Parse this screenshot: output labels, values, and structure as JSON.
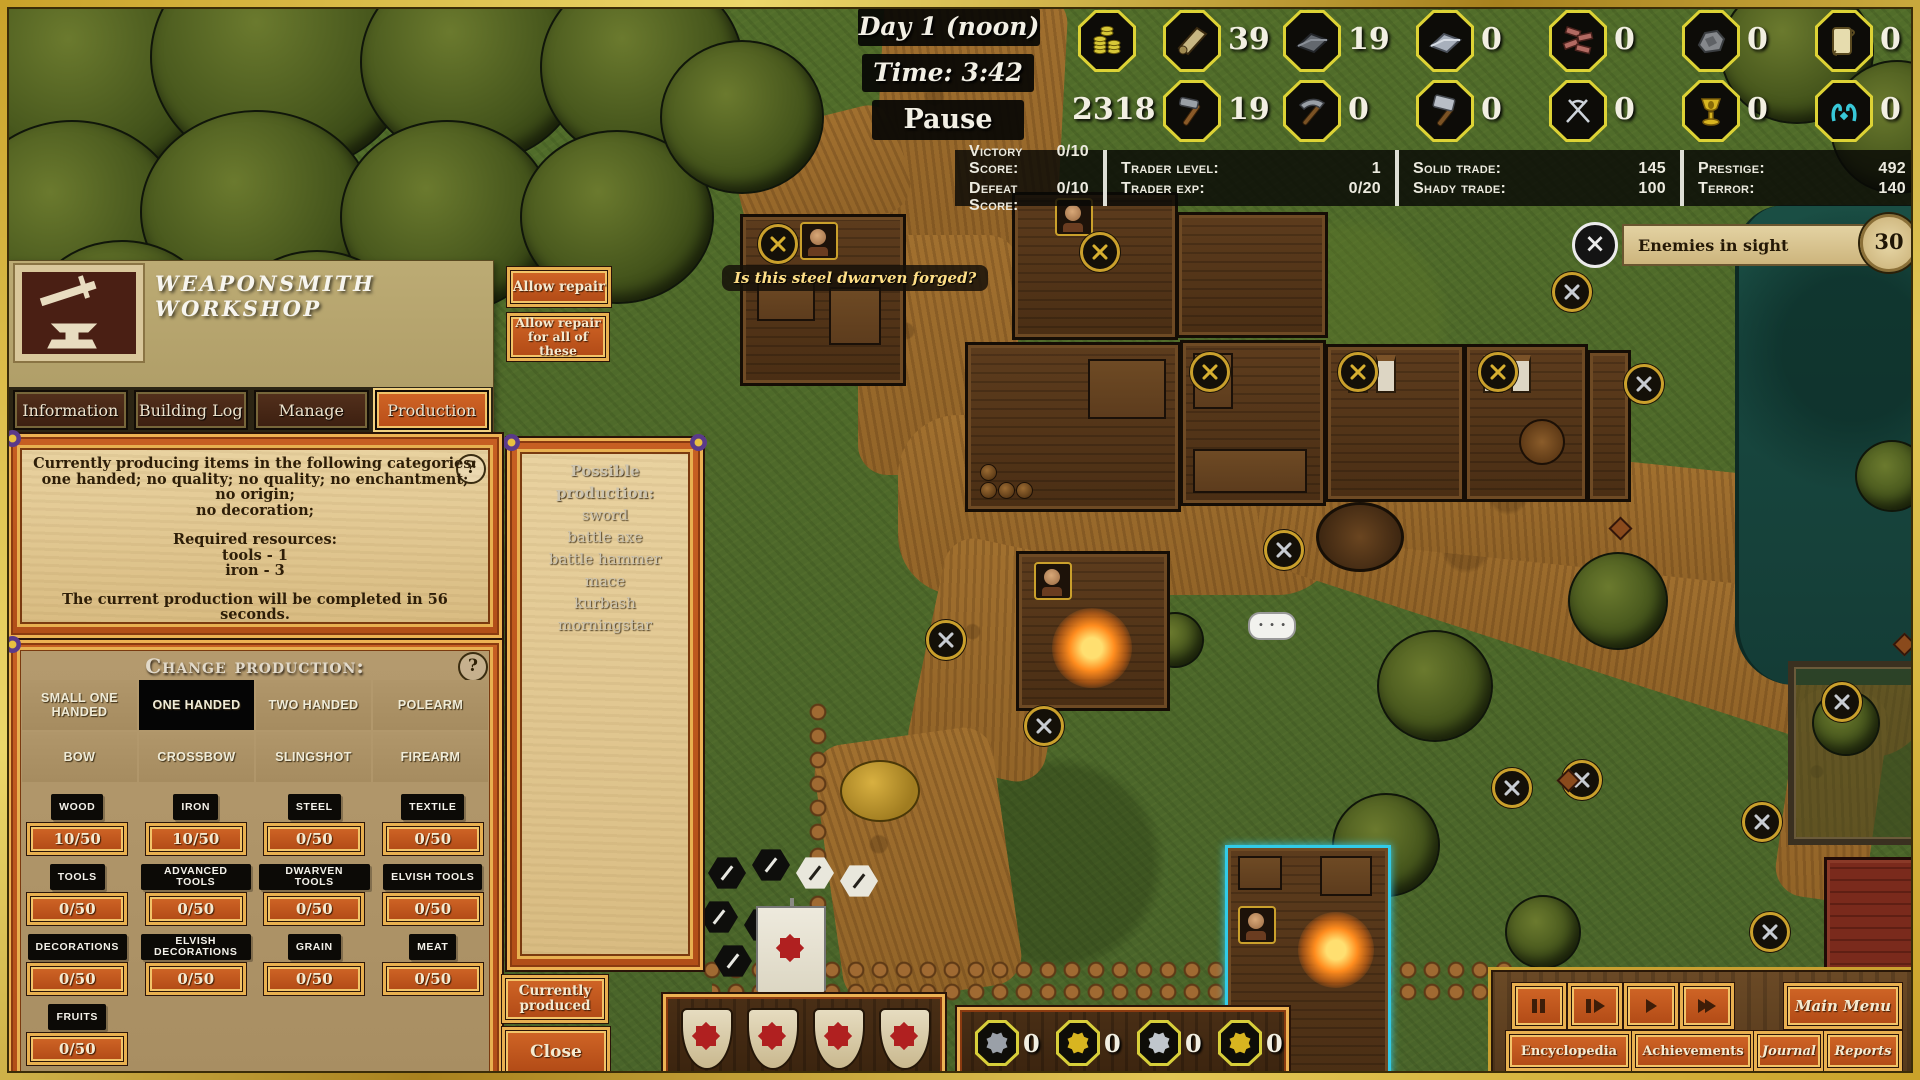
{
  "hud": {
    "day_label": "Day 1 (noon)",
    "time_label": "Time: 3:42",
    "pause_label": "Pause",
    "coins_total": "2318",
    "resources_top": [
      {
        "icon": "coins-icon",
        "count": ""
      },
      {
        "icon": "wood-icon",
        "count": "39"
      },
      {
        "icon": "iron-icon",
        "count": "19"
      },
      {
        "icon": "steel-icon",
        "count": "0"
      },
      {
        "icon": "bricks-icon",
        "count": "0"
      },
      {
        "icon": "stone-icon",
        "count": "0"
      },
      {
        "icon": "scroll-icon",
        "count": "0"
      }
    ],
    "resources_bottom": [
      {
        "icon": "tools-icon",
        "count": "19"
      },
      {
        "icon": "advanced-tools-icon",
        "count": "0"
      },
      {
        "icon": "dwarven-tools-icon",
        "count": "0"
      },
      {
        "icon": "elvish-tools-icon",
        "count": "0"
      },
      {
        "icon": "decorations-icon",
        "count": "0"
      },
      {
        "icon": "elvish-decorations-icon",
        "count": "0"
      }
    ],
    "scores": {
      "victory_label": "Victory Score:",
      "victory_value": "0/10",
      "defeat_label": "Defeat Score:",
      "defeat_value": "0/10",
      "trader_level_label": "Trader level:",
      "trader_level_value": "1",
      "trader_exp_label": "Trader exp:",
      "trader_exp_value": "0/20",
      "solid_label": "Solid trade:",
      "solid_value": "145",
      "shady_label": "Shady trade:",
      "shady_value": "100",
      "prestige_label": "Prestige:",
      "prestige_value": "492",
      "terror_label": "Terror:",
      "terror_value": "140"
    },
    "enemies": {
      "text": "Enemies in sight",
      "count": "30",
      "close": "×"
    }
  },
  "workshop": {
    "title": "WEAPONSMITH WORKSHOP",
    "tabs": [
      "Information",
      "Building Log",
      "Manage",
      "Production"
    ],
    "repair_button": "Allow repair",
    "repair_all_button": "Allow repair for all of these",
    "info": {
      "line1": "Currently producing items in the following categories:",
      "line2": "one handed; no quality; no quality; no enchantment; no origin;",
      "line3": "no decoration;",
      "required_title": "Required resources:",
      "req1": "tools - 1",
      "req2": "iron - 3",
      "completion": "The current production will be completed in 56 seconds.",
      "help": "?"
    },
    "change_production": {
      "title": "Change production:",
      "help": "?",
      "categories": [
        "SMALL ONE HANDED",
        "ONE HANDED",
        "TWO HANDED",
        "POLEARM",
        "BOW",
        "CROSSBOW",
        "SLINGSHOT",
        "FIREARM"
      ],
      "active_category": "ONE HANDED",
      "stocks": [
        {
          "label": "WOOD",
          "value": "10/50"
        },
        {
          "label": "IRON",
          "value": "10/50"
        },
        {
          "label": "STEEL",
          "value": "0/50"
        },
        {
          "label": "TEXTILE",
          "value": "0/50"
        },
        {
          "label": "TOOLS",
          "value": "0/50"
        },
        {
          "label": "ADVANCED TOOLS",
          "value": "0/50"
        },
        {
          "label": "DWARVEN TOOLS",
          "value": "0/50"
        },
        {
          "label": "ELVISH TOOLS",
          "value": "0/50"
        },
        {
          "label": "DECORATIONS",
          "value": "0/50"
        },
        {
          "label": "ELVISH DECORATIONS",
          "value": "0/50"
        },
        {
          "label": "GRAIN",
          "value": "0/50"
        },
        {
          "label": "MEAT",
          "value": "0/50"
        },
        {
          "label": "FRUITS",
          "value": "0/50"
        }
      ]
    },
    "possible_production": {
      "title": "Possible production:",
      "items": [
        "sword",
        "battle axe",
        "battle hammer",
        "mace",
        "kurbash",
        "morningstar"
      ]
    },
    "currently_produced_button": "Currently produced",
    "close_button": "Close"
  },
  "map": {
    "speech_bubble": "Is this steel dwarven forged?"
  },
  "bottom": {
    "squad_counts": [
      "0",
      "0",
      "0",
      "0"
    ],
    "menu": {
      "main_menu": "Main Menu",
      "encyclopedia": "Encyclopedia",
      "achievements": "Achievements",
      "journal": "Journal",
      "reports": "Reports"
    }
  }
}
